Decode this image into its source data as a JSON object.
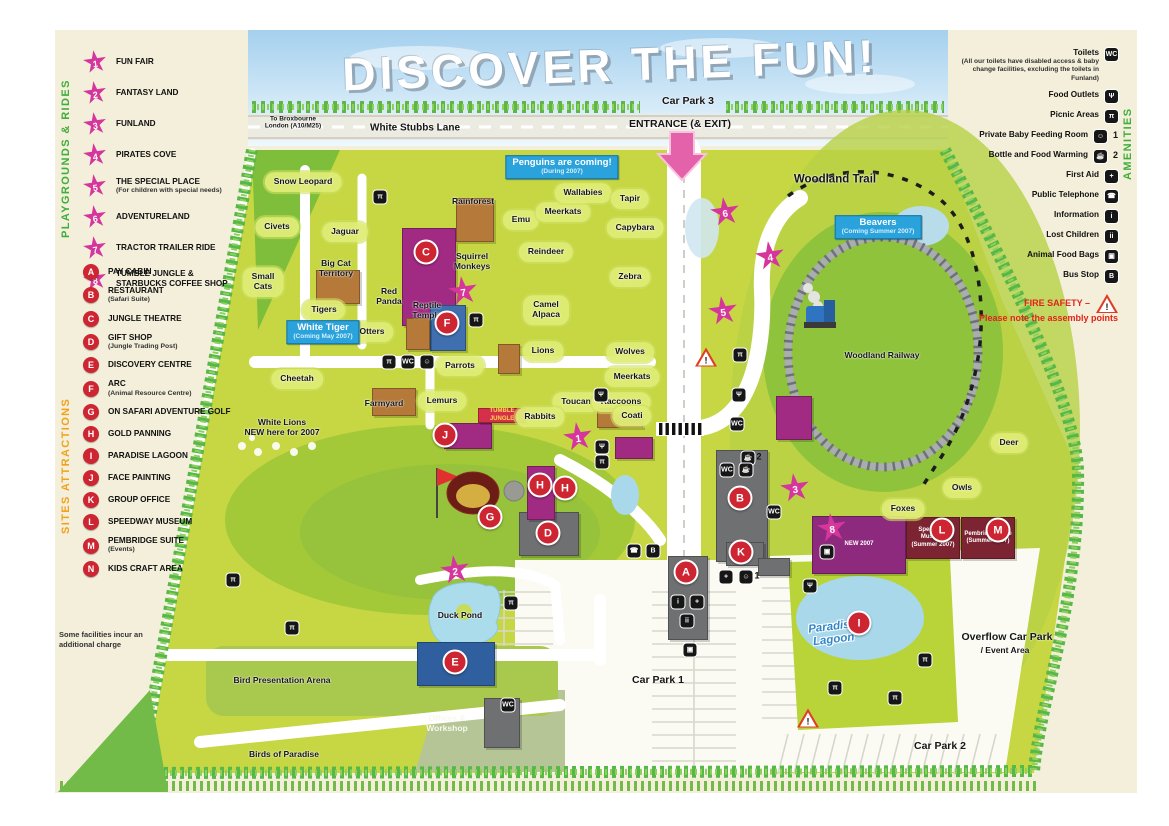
{
  "title": "DISCOVER THE FUN!",
  "colors": {
    "star_pink": "#d6359b",
    "marker_red": "#cd2531",
    "sign_blue": "#2aa2dc",
    "park_green": "#c6d743",
    "hedge_green": "#57b747"
  },
  "icon_glyphs": {
    "toilets": "WC",
    "food": "Ψ",
    "picnic": "π",
    "baby": "☺",
    "bottle": "☕",
    "firstaid": "+",
    "phone": "☎",
    "info": "i",
    "lost": "ii",
    "foodbag": "▣",
    "bus": "B"
  },
  "legend_left": {
    "playgrounds": {
      "heading": "PLAYGROUNDS & RIDES",
      "items": [
        {
          "num": "1",
          "label": "FUN FAIR"
        },
        {
          "num": "2",
          "label": "FANTASY LAND"
        },
        {
          "num": "3",
          "label": "FUNLAND"
        },
        {
          "num": "4",
          "label": "PIRATES COVE"
        },
        {
          "num": "5",
          "label": "THE SPECIAL PLACE",
          "sub": "(For children with special needs)"
        },
        {
          "num": "6",
          "label": "ADVENTURELAND"
        },
        {
          "num": "7",
          "label": "TRACTOR TRAILER RIDE"
        },
        {
          "num": "8",
          "label": "TUMBLE JUNGLE & STARBUCKS COFFEE SHOP"
        }
      ]
    },
    "sites": {
      "heading": "SITES ATTRACTIONS",
      "items": [
        {
          "letter": "A",
          "label": "PAY CABIN"
        },
        {
          "letter": "B",
          "label": "RESTAURANT",
          "sub": "(Safari Suite)"
        },
        {
          "letter": "C",
          "label": "JUNGLE THEATRE"
        },
        {
          "letter": "D",
          "label": "GIFT SHOP",
          "sub": "(Jungle Trading Post)"
        },
        {
          "letter": "E",
          "label": "DISCOVERY CENTRE"
        },
        {
          "letter": "F",
          "label": "ARC",
          "sub": "(Animal Resource Centre)"
        },
        {
          "letter": "G",
          "label": "ON SAFARI ADVENTURE GOLF"
        },
        {
          "letter": "H",
          "label": "GOLD PANNING"
        },
        {
          "letter": "I",
          "label": "PARADISE LAGOON"
        },
        {
          "letter": "J",
          "label": "FACE PAINTING"
        },
        {
          "letter": "K",
          "label": "GROUP OFFICE"
        },
        {
          "letter": "L",
          "label": "SPEEDWAY MUSEUM"
        },
        {
          "letter": "M",
          "label": "PEMBRIDGE SUITE",
          "sub": "(Events)"
        },
        {
          "letter": "N",
          "label": "KIDS CRAFT AREA"
        }
      ]
    },
    "note": "Some facilities incur an additional charge"
  },
  "legend_right": {
    "heading": "AMENITIES",
    "items": [
      {
        "label": "Toilets",
        "icon": "toilets",
        "sub": "(All our toilets have disabled access & baby change facilities, excluding the toilets in Funland)"
      },
      {
        "label": "Food Outlets",
        "icon": "food"
      },
      {
        "label": "Picnic Areas",
        "icon": "picnic"
      },
      {
        "label": "Private Baby Feeding Room",
        "icon": "baby",
        "num": "1"
      },
      {
        "label": "Bottle and Food Warming",
        "icon": "bottle",
        "num": "2"
      },
      {
        "label": "First Aid",
        "icon": "firstaid"
      },
      {
        "label": "Public Telephone",
        "icon": "phone"
      },
      {
        "label": "Information",
        "icon": "info"
      },
      {
        "label": "Lost Children",
        "icon": "lost"
      },
      {
        "label": "Animal Food Bags",
        "icon": "foodbag"
      },
      {
        "label": "Bus Stop",
        "icon": "bus"
      }
    ],
    "fire_safety": {
      "title": "FIRE SAFETY –",
      "text": "Please note the assembly points"
    }
  },
  "map": {
    "labels": [
      {
        "t": "Snow Leopard",
        "x": 303,
        "y": 182,
        "c": "pen"
      },
      {
        "t": "Civets",
        "x": 277,
        "y": 227,
        "c": "pen"
      },
      {
        "t": "Jaguar",
        "x": 345,
        "y": 232,
        "c": "pen"
      },
      {
        "t": "Small\nCats",
        "x": 263,
        "y": 282,
        "c": "pen"
      },
      {
        "t": "Big Cat\nTerritory",
        "x": 336,
        "y": 269
      },
      {
        "t": "Tigers",
        "x": 324,
        "y": 310,
        "c": "pen"
      },
      {
        "t": "Otters",
        "x": 372,
        "y": 332,
        "c": "pen"
      },
      {
        "t": "Cheetah",
        "x": 297,
        "y": 379,
        "c": "pen"
      },
      {
        "t": "Red\nPanda",
        "x": 389,
        "y": 297
      },
      {
        "t": "Reptile\nTemple",
        "x": 427,
        "y": 311
      },
      {
        "t": "Rainforest",
        "x": 473,
        "y": 202
      },
      {
        "t": "Squirrel\nMonkeys",
        "x": 472,
        "y": 262
      },
      {
        "t": "Emu",
        "x": 521,
        "y": 220,
        "c": "pen"
      },
      {
        "t": "Meerkats",
        "x": 563,
        "y": 212,
        "c": "pen"
      },
      {
        "t": "Wallabies",
        "x": 583,
        "y": 193,
        "c": "pen"
      },
      {
        "t": "Tapir",
        "x": 630,
        "y": 199,
        "c": "pen"
      },
      {
        "t": "Capybara",
        "x": 635,
        "y": 228,
        "c": "pen"
      },
      {
        "t": "Reindeer",
        "x": 546,
        "y": 252,
        "c": "pen"
      },
      {
        "t": "Zebra",
        "x": 630,
        "y": 277,
        "c": "pen"
      },
      {
        "t": "Camel\nAlpaca",
        "x": 546,
        "y": 310,
        "c": "pen"
      },
      {
        "t": "Lions",
        "x": 543,
        "y": 351,
        "c": "pen"
      },
      {
        "t": "Wolves",
        "x": 630,
        "y": 352,
        "c": "pen"
      },
      {
        "t": "Meerkats",
        "x": 632,
        "y": 377,
        "c": "pen"
      },
      {
        "t": "Parrots",
        "x": 460,
        "y": 366,
        "c": "pen"
      },
      {
        "t": "Toucan",
        "x": 576,
        "y": 402,
        "c": "pen"
      },
      {
        "t": "Raccoons",
        "x": 621,
        "y": 402,
        "c": "pen"
      },
      {
        "t": "Coati",
        "x": 632,
        "y": 416,
        "c": "pen"
      },
      {
        "t": "Rabbits",
        "x": 540,
        "y": 417,
        "c": "pen"
      },
      {
        "t": "Lemurs",
        "x": 442,
        "y": 401,
        "c": "pen"
      },
      {
        "t": "Farmyard",
        "x": 384,
        "y": 404
      },
      {
        "t": "White Lions\nNEW here for 2007",
        "x": 282,
        "y": 428
      },
      {
        "t": "Duck Pond",
        "x": 460,
        "y": 616
      },
      {
        "t": "Bird Presentation Arena",
        "x": 282,
        "y": 681
      },
      {
        "t": "Birds of Paradise",
        "x": 284,
        "y": 755
      },
      {
        "t": "Offices &\nWorkshop",
        "x": 447,
        "y": 724,
        "c": "white"
      },
      {
        "t": "Woodland Trail",
        "x": 835,
        "y": 180,
        "c": "wt"
      },
      {
        "t": "Woodland Railway",
        "x": 882,
        "y": 356
      },
      {
        "t": "Deer",
        "x": 1009,
        "y": 443,
        "c": "pen"
      },
      {
        "t": "Owls",
        "x": 962,
        "y": 488,
        "c": "pen"
      },
      {
        "t": "Foxes",
        "x": 903,
        "y": 509,
        "c": "pen"
      },
      {
        "t": "Car Park 1",
        "x": 658,
        "y": 680,
        "c": "big"
      },
      {
        "t": "Car Park 2",
        "x": 940,
        "y": 746,
        "c": "big"
      },
      {
        "t": "Overflow Car Park",
        "x": 1007,
        "y": 637,
        "c": "big"
      },
      {
        "t": "/ Event Area",
        "x": 1005,
        "y": 651
      },
      {
        "t": "Car Park 3",
        "x": 688,
        "y": 101,
        "c": "big"
      },
      {
        "t": "ENTRANCE (& EXIT)",
        "x": 680,
        "y": 124,
        "c": "big"
      },
      {
        "t": "White Stubbs Lane",
        "x": 415,
        "y": 128,
        "c": "road"
      },
      {
        "t": "To Broxbourne\nLondon (A10/M25)",
        "x": 293,
        "y": 123,
        "c": "tiny"
      },
      {
        "t": "Paradise\nLagoon",
        "x": 833,
        "y": 634,
        "c": "logo"
      }
    ],
    "stars": [
      {
        "n": "1",
        "x": 578,
        "y": 437
      },
      {
        "n": "2",
        "x": 455,
        "y": 570
      },
      {
        "n": "3",
        "x": 795,
        "y": 488
      },
      {
        "n": "4",
        "x": 770,
        "y": 256
      },
      {
        "n": "5",
        "x": 723,
        "y": 311
      },
      {
        "n": "6",
        "x": 725,
        "y": 212
      },
      {
        "n": "7",
        "x": 463,
        "y": 291
      },
      {
        "n": "8",
        "x": 832,
        "y": 528
      }
    ],
    "markers": [
      {
        "l": "A",
        "x": 686,
        "y": 572
      },
      {
        "l": "B",
        "x": 740,
        "y": 498
      },
      {
        "l": "C",
        "x": 426,
        "y": 252
      },
      {
        "l": "D",
        "x": 548,
        "y": 533
      },
      {
        "l": "E",
        "x": 455,
        "y": 662
      },
      {
        "l": "F",
        "x": 447,
        "y": 323
      },
      {
        "l": "G",
        "x": 490,
        "y": 517
      },
      {
        "l": "H",
        "x": 540,
        "y": 485
      },
      {
        "l": "H",
        "x": 565,
        "y": 488
      },
      {
        "l": "I",
        "x": 859,
        "y": 623
      },
      {
        "l": "J",
        "x": 445,
        "y": 435
      },
      {
        "l": "K",
        "x": 741,
        "y": 552
      },
      {
        "l": "L",
        "x": 942,
        "y": 530
      },
      {
        "l": "M",
        "x": 998,
        "y": 530
      }
    ],
    "buildings": [
      {
        "name": "jungle-theatre",
        "color": "#a12a82",
        "x": 402,
        "y": 228,
        "w": 52,
        "h": 96
      },
      {
        "name": "rainforest-house",
        "color": "#b5793a",
        "x": 456,
        "y": 198,
        "w": 36,
        "h": 42
      },
      {
        "name": "arc",
        "color": "#3f6fae",
        "x": 430,
        "y": 305,
        "w": 34,
        "h": 44
      },
      {
        "name": "big-cat-house",
        "color": "#b5793a",
        "x": 316,
        "y": 270,
        "w": 42,
        "h": 32
      },
      {
        "name": "reptile-house",
        "color": "#b5793a",
        "x": 406,
        "y": 318,
        "w": 22,
        "h": 30
      },
      {
        "name": "farmyard-house",
        "color": "#b5793a",
        "x": 372,
        "y": 388,
        "w": 42,
        "h": 26
      },
      {
        "name": "lions-house",
        "color": "#b5793a",
        "x": 498,
        "y": 344,
        "w": 20,
        "h": 28
      },
      {
        "name": "toucan-house",
        "color": "#b5793a",
        "x": 597,
        "y": 408,
        "w": 44,
        "h": 18
      },
      {
        "name": "funfair-building",
        "color": "#a12a82",
        "x": 615,
        "y": 437,
        "w": 36,
        "h": 20
      },
      {
        "name": "woodland-building",
        "color": "#a12a82",
        "x": 776,
        "y": 396,
        "w": 34,
        "h": 42
      },
      {
        "name": "restaurant",
        "color": "#6f7072",
        "x": 716,
        "y": 450,
        "w": 50,
        "h": 110
      },
      {
        "name": "pay-cabin",
        "color": "#6f7072",
        "x": 668,
        "y": 556,
        "w": 38,
        "h": 82
      },
      {
        "name": "gift-shop",
        "color": "#6f7072",
        "x": 519,
        "y": 512,
        "w": 58,
        "h": 42
      },
      {
        "name": "group-office",
        "color": "#6f7072",
        "x": 726,
        "y": 542,
        "w": 36,
        "h": 22
      },
      {
        "name": "small-store",
        "color": "#6f7072",
        "x": 758,
        "y": 558,
        "w": 30,
        "h": 16
      },
      {
        "name": "discovery-centre",
        "color": "#2f5f9e",
        "x": 417,
        "y": 642,
        "w": 76,
        "h": 42
      },
      {
        "name": "offices-workshop-building",
        "color": "#6f7072",
        "x": 484,
        "y": 698,
        "w": 34,
        "h": 48
      },
      {
        "name": "gold-panning-building",
        "color": "#a12a82",
        "x": 527,
        "y": 466,
        "w": 26,
        "h": 52
      },
      {
        "name": "face-painting-building",
        "color": "#a12a82",
        "x": 444,
        "y": 423,
        "w": 46,
        "h": 24
      },
      {
        "name": "tumble-jungle-banner",
        "color": "#d5304a",
        "x": 478,
        "y": 408,
        "w": 46,
        "h": 13,
        "text": "TUMBLE JUNGLE",
        "tc": "#ffd84d"
      },
      {
        "name": "new-2007-building",
        "color": "#8e2a7e",
        "x": 812,
        "y": 516,
        "w": 92,
        "h": 56,
        "text": "NEW 2007",
        "tc": "#ffffff"
      },
      {
        "name": "speedway-museum-sign",
        "color": "#7d2433",
        "x": 906,
        "y": 517,
        "w": 52,
        "h": 40,
        "text": "Speedway Museum (Summer 2007)",
        "tc": "#ffffff"
      },
      {
        "name": "pembridge-suite-sign",
        "color": "#7d2433",
        "x": 961,
        "y": 517,
        "w": 52,
        "h": 40,
        "text": "Pembridge Suite (Summer 2007)",
        "tc": "#ffffff"
      }
    ],
    "chips": [
      {
        "ic": "picnic",
        "x": 380,
        "y": 197
      },
      {
        "ic": "picnic",
        "x": 476,
        "y": 320
      },
      {
        "ic": "picnic",
        "x": 389,
        "y": 362
      },
      {
        "ic": "toilets",
        "x": 408,
        "y": 362
      },
      {
        "ic": "baby",
        "x": 427,
        "y": 362
      },
      {
        "ic": "food",
        "x": 601,
        "y": 395
      },
      {
        "ic": "food",
        "x": 602,
        "y": 447
      },
      {
        "ic": "picnic",
        "x": 602,
        "y": 462
      },
      {
        "ic": "phone",
        "x": 634,
        "y": 551
      },
      {
        "ic": "bus",
        "x": 653,
        "y": 551
      },
      {
        "ic": "picnic",
        "x": 740,
        "y": 355
      },
      {
        "ic": "food",
        "x": 739,
        "y": 395
      },
      {
        "ic": "toilets",
        "x": 737,
        "y": 424
      },
      {
        "ic": "bottle",
        "x": 748,
        "y": 458,
        "txt": "2"
      },
      {
        "ic": "toilets",
        "x": 727,
        "y": 470
      },
      {
        "ic": "bottle",
        "x": 746,
        "y": 470
      },
      {
        "ic": "toilets",
        "x": 774,
        "y": 512
      },
      {
        "ic": "firstaid",
        "x": 726,
        "y": 577
      },
      {
        "ic": "baby",
        "x": 746,
        "y": 577,
        "txt": "1"
      },
      {
        "ic": "info",
        "x": 678,
        "y": 602
      },
      {
        "ic": "firstaid",
        "x": 697,
        "y": 602
      },
      {
        "ic": "lost",
        "x": 687,
        "y": 621
      },
      {
        "ic": "foodbag",
        "x": 690,
        "y": 650
      },
      {
        "ic": "picnic",
        "x": 511,
        "y": 603
      },
      {
        "ic": "picnic",
        "x": 233,
        "y": 580
      },
      {
        "ic": "picnic",
        "x": 292,
        "y": 628
      },
      {
        "ic": "toilets",
        "x": 508,
        "y": 705
      },
      {
        "ic": "food",
        "x": 810,
        "y": 586
      },
      {
        "ic": "foodbag",
        "x": 827,
        "y": 552
      },
      {
        "ic": "picnic",
        "x": 925,
        "y": 660
      },
      {
        "ic": "picnic",
        "x": 835,
        "y": 688
      },
      {
        "ic": "picnic",
        "x": 895,
        "y": 698
      }
    ],
    "signs": [
      {
        "title": "Penguins are coming!",
        "sub": "(During 2007)",
        "x": 562,
        "y": 167
      },
      {
        "title": "White Tiger",
        "sub": "(Coming May 2007)",
        "x": 323,
        "y": 332
      },
      {
        "title": "Beavers",
        "sub": "(Coming Summer 2007)",
        "x": 878,
        "y": 227
      }
    ],
    "fire_points": [
      {
        "x": 706,
        "y": 357
      },
      {
        "x": 808,
        "y": 718
      }
    ]
  }
}
